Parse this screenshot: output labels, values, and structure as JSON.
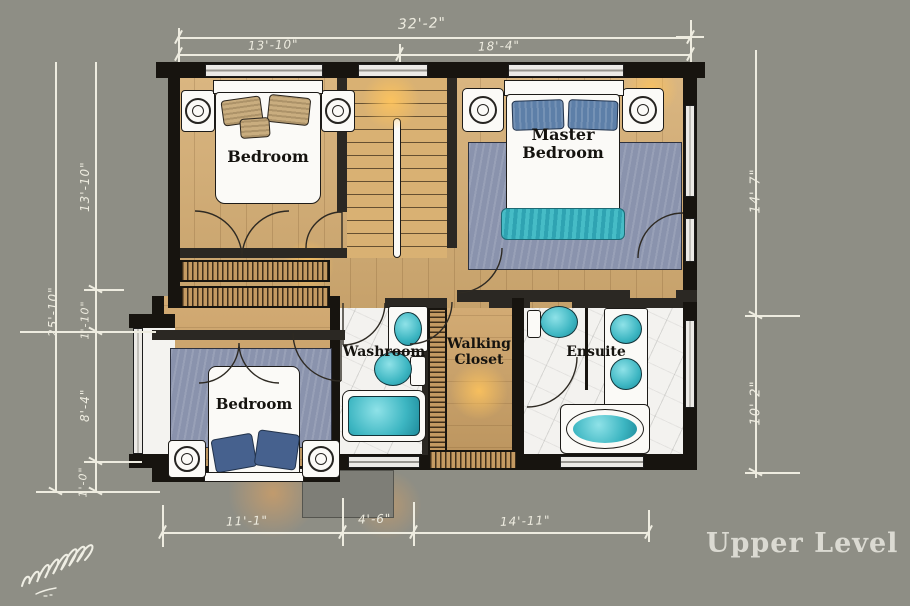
{
  "title": "Upper Level",
  "rooms": {
    "bedroom_top_left": {
      "label": "Bedroom"
    },
    "master_bedroom": {
      "label": "Master Bedroom"
    },
    "bedroom_bottom_left": {
      "label": "Bedroom"
    },
    "washroom": {
      "label": "Washroom"
    },
    "walking_closet": {
      "label": "Walking Closet"
    },
    "ensuite": {
      "label": "Ensuite"
    }
  },
  "dimensions": {
    "top": {
      "overall": "32'-2\"",
      "segments": [
        "13'-10\"",
        "18'-4\""
      ]
    },
    "left": {
      "overall": "25'-10\"",
      "segments": [
        "13'-10\"",
        "1'-10\"",
        "8'-4\"",
        "1'-0\""
      ]
    },
    "right": {
      "segments": [
        "14'-7\"",
        "10'-2\""
      ]
    },
    "bottom": {
      "segments": [
        "11'-1\"",
        "4'-6\"",
        "14'-11\""
      ]
    }
  },
  "palette": {
    "background": "#8e8e85",
    "wood_floor": "#d7af74",
    "wall": "#17140f",
    "marble": "#f3f2ef",
    "fixture_teal": "#3db6c2",
    "rug_blue": "#8a93ad",
    "dimension_ink": "#eeece0",
    "title_ink": "#dbdad2"
  }
}
